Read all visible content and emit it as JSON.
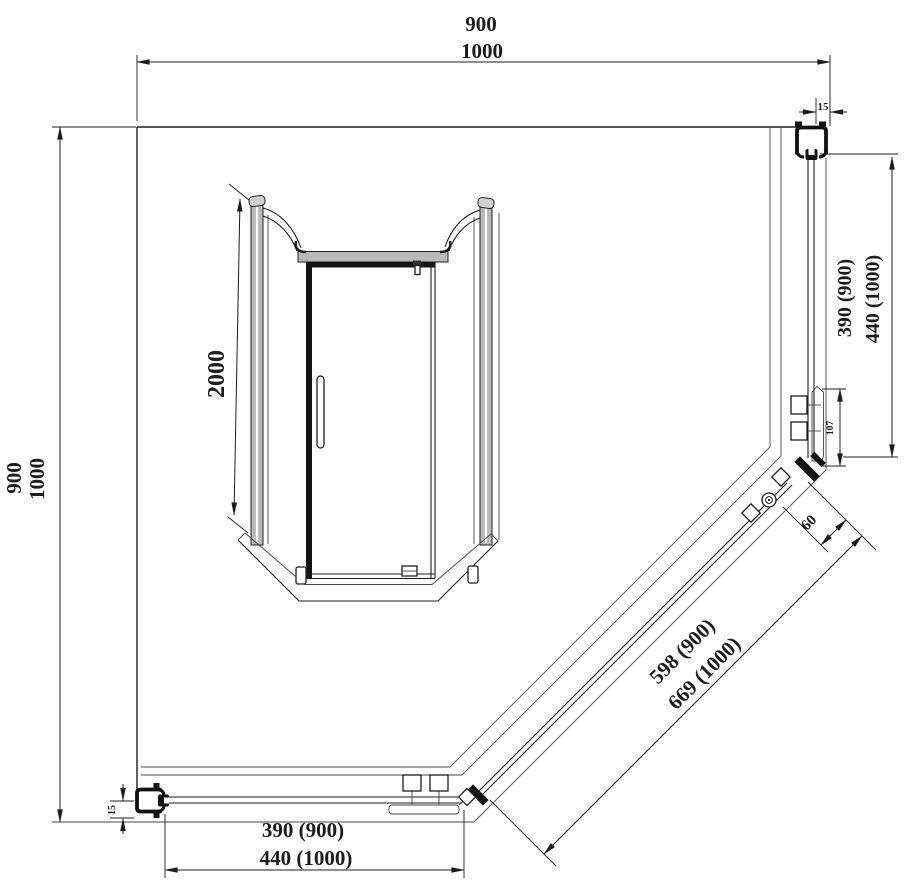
{
  "plan_view": {
    "overall_width": {
      "primary": "900",
      "secondary": "1000"
    },
    "overall_depth": {
      "primary": "900",
      "secondary": "1000"
    },
    "side_panel_right": {
      "primary": "390 (900)",
      "secondary": "440 (1000)"
    },
    "side_panel_bottom": {
      "primary": "390 (900)",
      "secondary": "440 (1000)"
    },
    "door_diagonal": {
      "primary": "598 (900)",
      "secondary": "669 (1000)"
    },
    "wall_profile_top": "15",
    "wall_profile_bottom": "15",
    "clamp_bracket": "107",
    "corner_post": "60"
  },
  "elevation_view": {
    "height": "2000"
  },
  "colors": {
    "line": "#1c1c1c",
    "metal_gray": "#b9b9b9",
    "background": "#ffffff"
  }
}
